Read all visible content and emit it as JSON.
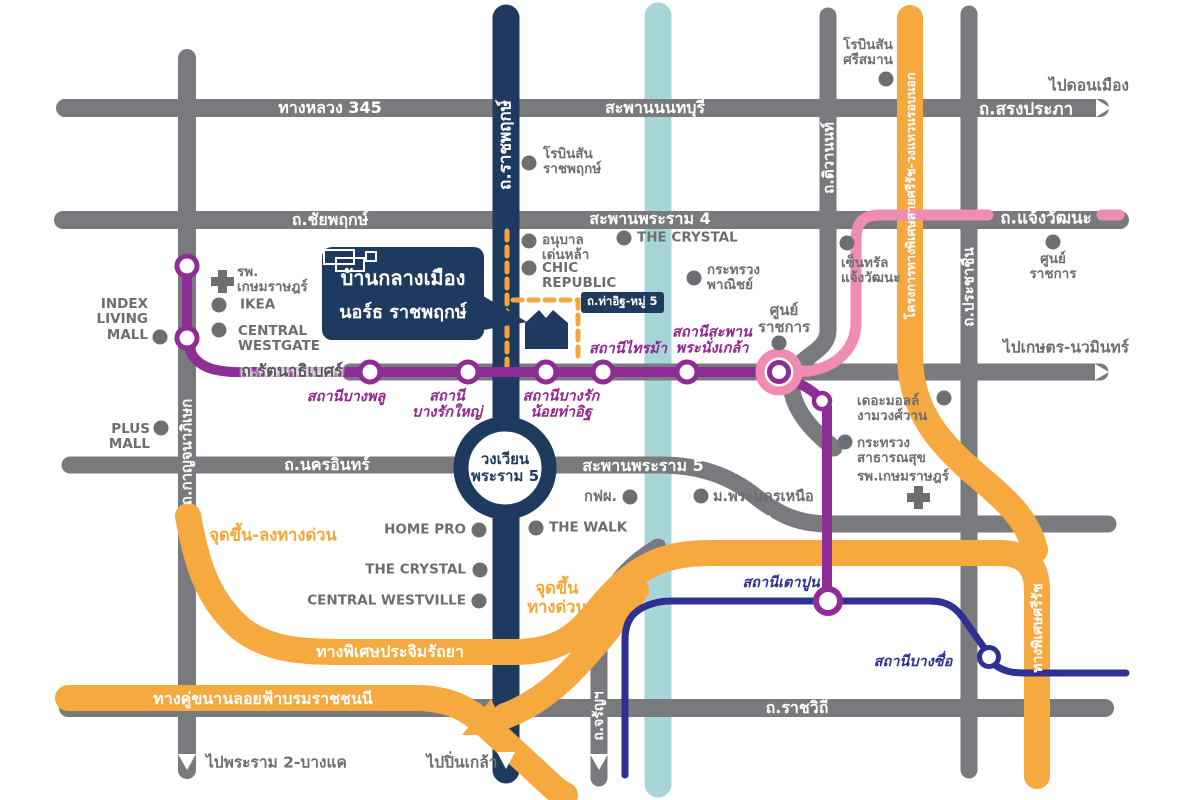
{
  "title": "Baan Klang Muang North Ratchaphruek location map",
  "palette": {
    "gray": "#797A7D",
    "poiGray": "#6D6E71",
    "navy": "#1E3A5F",
    "purple": "#8F2D96",
    "stationLabel": "#93278F",
    "pink": "#F08CB4",
    "orange": "#F6A93F",
    "orangeDash": "#F2A63B",
    "orangeLabel": "#F5A733",
    "teal": "#A8D6D8",
    "blue": "#2E3192"
  },
  "callout": {
    "line1": "บ้านกลางเมือง",
    "line2": "นอร์ธ ราชพฤกษ์"
  },
  "tha_it_badge": "ถ.ท่าอิฐ-หมู่ 5",
  "labels": [
    {
      "name": "road-label-highway-345",
      "text": "ทางหลวง 345",
      "cls": "rw",
      "x": 330,
      "y": 108,
      "align": "center"
    },
    {
      "name": "road-label-saphan-nonthaburi",
      "text": "สะพานนนทบุรี",
      "cls": "rw",
      "x": 655,
      "y": 108,
      "align": "center"
    },
    {
      "name": "direction-label-don-mueang",
      "text": "ไปดอนเมือง",
      "cls": "dir",
      "x": 1089,
      "y": 86,
      "align": "center"
    },
    {
      "name": "road-label-song-prapha",
      "text": "ถ.สรงประภา",
      "cls": "rw",
      "x": 1026,
      "y": 110,
      "align": "center",
      "fs": 17
    },
    {
      "name": "poi-label-robinson-srisaman",
      "text": "โรบินสัน\nศรีสมาน",
      "cls": "poi",
      "x": 868,
      "y": 53,
      "align": "center"
    },
    {
      "name": "road-label-chaiyaphruek",
      "text": "ถ.ชัยพฤกษ์",
      "cls": "rw",
      "x": 330,
      "y": 220,
      "align": "center"
    },
    {
      "name": "road-label-saphan-phra-ram-4",
      "text": "สะพานพระราม 4",
      "cls": "rw",
      "x": 650,
      "y": 219,
      "align": "center"
    },
    {
      "name": "road-label-chaengwattana",
      "text": "ถ.แจ้งวัฒนะ",
      "cls": "rw",
      "x": 1046,
      "y": 219,
      "align": "center",
      "fs": 17
    },
    {
      "name": "poi-label-robinson-ratchaphruek",
      "text": "โรบินสัน\nราชพฤกษ์",
      "cls": "poi",
      "x": 543,
      "y": 162,
      "align": "left"
    },
    {
      "name": "road-label-ratchaphruek",
      "text": "ถ.ราชพฤกษ์",
      "cls": "rw",
      "x": 506,
      "y": 145,
      "align": "center",
      "rot": -90,
      "fs": 17
    },
    {
      "name": "road-label-tiwanon",
      "text": "ถ.ติวานนท์",
      "cls": "rw",
      "x": 829,
      "y": 158,
      "align": "center",
      "rot": -90,
      "fs": 15
    },
    {
      "name": "road-label-outer-ring-expressway",
      "text": "โครงการทางพิเศษสายศรีรัช-วงแหวนรอบนอก",
      "cls": "rw",
      "x": 911,
      "y": 196,
      "align": "center",
      "rot": -90,
      "fs": 12.5
    },
    {
      "name": "road-label-prachachuen",
      "text": "ถ.ประชาชื่น",
      "cls": "rw",
      "x": 969,
      "y": 287,
      "align": "center",
      "rot": -90,
      "fs": 15
    },
    {
      "name": "poi-label-anuban-denla",
      "text": "อนุบาล\nเด่นหล้า",
      "cls": "poi",
      "x": 542,
      "y": 248,
      "align": "left"
    },
    {
      "name": "poi-label-chic-republic",
      "text": "CHIC\nREPUBLIC",
      "cls": "poi",
      "x": 542,
      "y": 276,
      "align": "left"
    },
    {
      "name": "poi-label-the-crystal-north",
      "text": "THE CRYSTAL",
      "cls": "poi",
      "x": 637,
      "y": 238,
      "align": "left"
    },
    {
      "name": "poi-label-ministry-commerce",
      "text": "กระทรวง\nพาณิชย์",
      "cls": "poi",
      "x": 707,
      "y": 278,
      "align": "left"
    },
    {
      "name": "poi-label-central-chaengwattana",
      "text": "เซ็นทรัล\nแจ้งวัฒนะ",
      "cls": "poi",
      "x": 841,
      "y": 271,
      "align": "left"
    },
    {
      "name": "poi-label-government-complex-east",
      "text": "ศูนย์\nราชการ",
      "cls": "poi",
      "x": 1053,
      "y": 267,
      "align": "center"
    },
    {
      "name": "poi-label-government-complex-center",
      "text": "ศูนย์\nราชการ",
      "cls": "poi",
      "x": 784,
      "y": 319,
      "align": "center",
      "fs": 15
    },
    {
      "name": "station-label-bang-phlu",
      "text": "สถานีบางพลู",
      "cls": "st",
      "x": 346,
      "y": 397,
      "align": "center"
    },
    {
      "name": "station-label-bang-rak-yai",
      "text": "สถานี\nบางรักใหญ่",
      "cls": "st",
      "x": 447,
      "y": 405,
      "align": "center"
    },
    {
      "name": "station-label-bang-rak-noi-tha-it",
      "text": "สถานีบางรัก\nน้อยท่าอิฐ",
      "cls": "st",
      "x": 561,
      "y": 405,
      "align": "center"
    },
    {
      "name": "station-label-sai-ma",
      "text": "สถานีไทรม้า",
      "cls": "st",
      "x": 628,
      "y": 349,
      "align": "center"
    },
    {
      "name": "station-label-phra-nang-klao",
      "text": "สถานีสะพาน\nพระนั่งเกล้า",
      "cls": "st",
      "x": 712,
      "y": 341,
      "align": "center"
    },
    {
      "name": "road-label-rattanathibet",
      "text": "ถ.รัตนาธิเบศร์",
      "cls": "rtb",
      "x": 292,
      "y": 372,
      "align": "center"
    },
    {
      "name": "direction-label-kaset-nawamin",
      "text": "ไปเกษตร-นวมินทร์",
      "cls": "dir",
      "x": 1066,
      "y": 348,
      "align": "center"
    },
    {
      "name": "poi-label-index-living-mall",
      "text": "INDEX\nLIVING\nMALL",
      "cls": "poi",
      "x": 148,
      "y": 320,
      "align": "right"
    },
    {
      "name": "poi-label-kasem-hospital-west",
      "text": "รพ.\nเกษมราษฎร์",
      "cls": "poi",
      "x": 237,
      "y": 280,
      "align": "left"
    },
    {
      "name": "poi-label-ikea",
      "text": "IKEA",
      "cls": "poi",
      "x": 240,
      "y": 305,
      "align": "left"
    },
    {
      "name": "poi-label-central-westgate",
      "text": "CENTRAL\nWESTGATE",
      "cls": "poi",
      "x": 238,
      "y": 339,
      "align": "left"
    },
    {
      "name": "poi-label-plus-mall",
      "text": "PLUS\nMALL",
      "cls": "poi",
      "x": 150,
      "y": 437,
      "align": "right"
    },
    {
      "name": "road-label-nakhon-in",
      "text": "ถ.นครอินทร์",
      "cls": "rw",
      "x": 327,
      "y": 465,
      "align": "center"
    },
    {
      "name": "roundabout-label-phra-ram-5",
      "text": "วงเวียน\nพระราม 5",
      "cls": "navytext",
      "x": 505,
      "y": 468,
      "align": "center"
    },
    {
      "name": "road-label-saphan-phra-ram-5",
      "text": "สะพานพระราม 5",
      "cls": "rw",
      "x": 643,
      "y": 466,
      "align": "center"
    },
    {
      "name": "poi-label-egat",
      "text": "กฟผ.",
      "cls": "poi",
      "x": 617,
      "y": 497,
      "align": "right",
      "fs": 14.5
    },
    {
      "name": "poi-label-kmutnb",
      "text": "ม.พระนครเหนือ",
      "cls": "poi",
      "x": 713,
      "y": 497,
      "align": "left",
      "fs": 14.5
    },
    {
      "name": "road-label-wong-sawang",
      "text": "ถ.วงศ์สว่าง",
      "cls": "rw",
      "x": 733,
      "y": 524,
      "align": "center",
      "rot": -7
    },
    {
      "name": "poi-label-the-mall-ngamwongwan",
      "text": "เดอะมอลล์\nงามวงศ์วาน",
      "cls": "poi",
      "x": 857,
      "y": 409,
      "align": "left"
    },
    {
      "name": "poi-label-ministry-public-health",
      "text": "กระทรวง\nสาธารณสุข",
      "cls": "poi",
      "x": 857,
      "y": 451,
      "align": "left"
    },
    {
      "name": "poi-label-kasem-hospital-east",
      "text": "รพ.เกษมราษฎร์",
      "cls": "poi",
      "x": 903,
      "y": 477,
      "align": "center"
    },
    {
      "name": "poi-label-home-pro",
      "text": "HOME PRO",
      "cls": "poi",
      "x": 466,
      "y": 530,
      "align": "right"
    },
    {
      "name": "poi-label-the-walk",
      "text": "THE WALK",
      "cls": "poi",
      "x": 549,
      "y": 528,
      "align": "left"
    },
    {
      "name": "poi-label-the-crystal-south",
      "text": "THE CRYSTAL",
      "cls": "poi",
      "x": 466,
      "y": 570,
      "align": "right"
    },
    {
      "name": "poi-label-central-westville",
      "text": "CENTRAL WESTVILLE",
      "cls": "poi",
      "x": 466,
      "y": 601,
      "align": "right"
    },
    {
      "name": "road-label-kanchanaphisek",
      "text": "ถ.กาญจนาภิเษก",
      "cls": "rw",
      "x": 187,
      "y": 452,
      "align": "center",
      "rot": -90,
      "fs": 15
    },
    {
      "name": "label-expressway-entry-exit",
      "text": "จุดขึ้น-ลงทางด่วน",
      "cls": "or",
      "x": 273,
      "y": 536,
      "align": "center"
    },
    {
      "name": "label-expressway-entry",
      "text": "จุดขึ้น\nทางด่วน",
      "cls": "or",
      "x": 557,
      "y": 598,
      "align": "center"
    },
    {
      "name": "road-label-prachim-ratthaya",
      "text": "ทางพิเศษประจิมรัถยา",
      "cls": "rw",
      "x": 390,
      "y": 652,
      "align": "center"
    },
    {
      "name": "road-label-borommaratchachonnani",
      "text": "ทางคู่ขนานลอยฟ้าบรมราชชนนี",
      "cls": "rw",
      "x": 263,
      "y": 699,
      "align": "center"
    },
    {
      "name": "direction-label-phra-ram-2",
      "text": "ไปพระราม 2-บางแค",
      "cls": "dir",
      "x": 206,
      "y": 763,
      "align": "left"
    },
    {
      "name": "direction-label-pin-klao",
      "text": "ไปปิ่นเกล้า",
      "cls": "dir",
      "x": 462,
      "y": 763,
      "align": "center"
    },
    {
      "name": "road-label-charan",
      "text": "ถ.จรัญฯ",
      "cls": "rw",
      "x": 600,
      "y": 716,
      "align": "center",
      "rot": -90,
      "fs": 14
    },
    {
      "name": "road-label-ratchawithi",
      "text": "ถ.ราชวิถี",
      "cls": "rw",
      "x": 797,
      "y": 708,
      "align": "center"
    },
    {
      "name": "station-label-tao-pun",
      "text": "สถานีเตาปูน",
      "cls": "stb",
      "x": 781,
      "y": 583,
      "align": "center"
    },
    {
      "name": "station-label-bang-sue",
      "text": "สถานีบางซื่อ",
      "cls": "stb",
      "x": 913,
      "y": 662,
      "align": "center"
    },
    {
      "name": "road-label-si-rat-expressway",
      "text": "ทางพิเศษศรีรัช",
      "cls": "rw",
      "x": 1039,
      "y": 628,
      "align": "center",
      "rot": -90,
      "fs": 14
    }
  ]
}
